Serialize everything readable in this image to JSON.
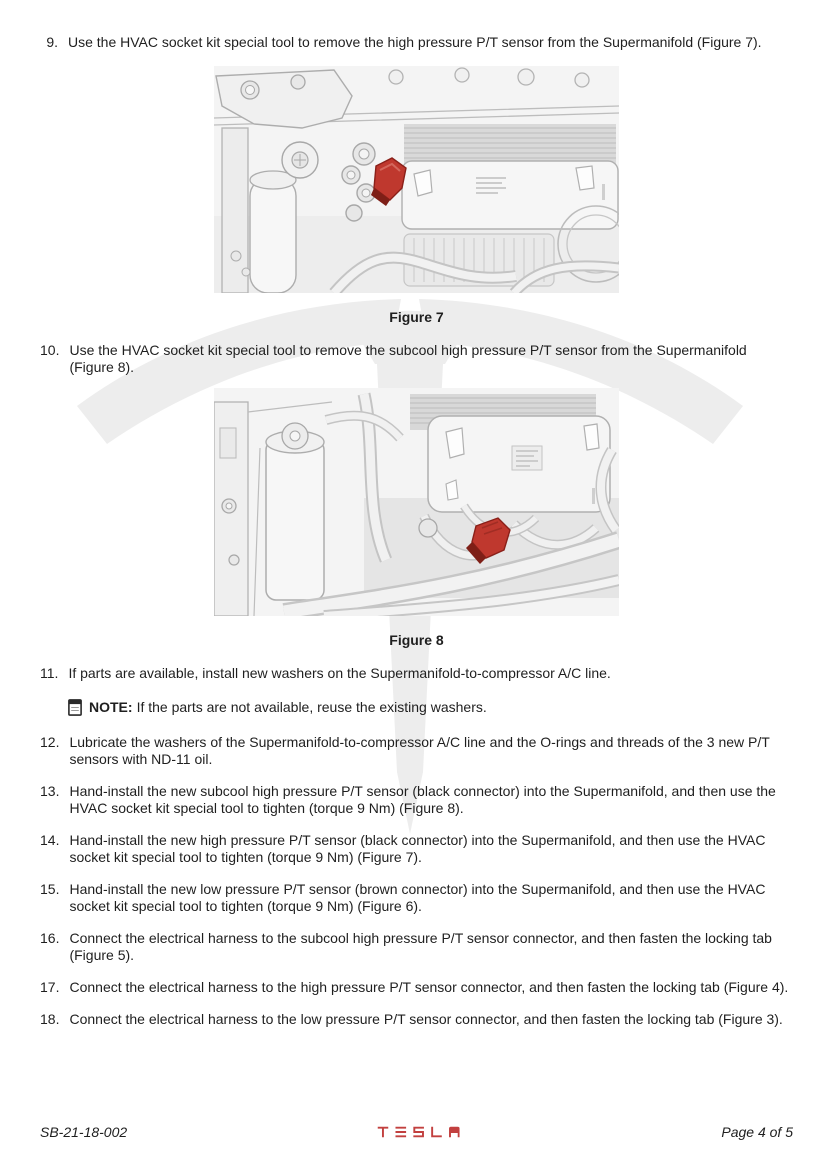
{
  "page": {
    "background": "#ffffff",
    "text_color": "#1f1f1f",
    "watermark_icon": "tesla-t-logo-watermark",
    "watermark_color": "#ededed",
    "highlight_color": "#bf382e"
  },
  "steps": [
    {
      "number": "9.",
      "text": "Use the HVAC socket kit special tool to remove the high pressure P/T sensor from the Supermanifold (Figure 7)."
    },
    {
      "number": "10.",
      "text": "Use the HVAC socket kit special tool to remove the subcool high pressure P/T sensor from the Supermanifold (Figure 8)."
    },
    {
      "number": "11.",
      "text": "If parts are available, install new washers on the Supermanifold-to-compressor A/C line."
    },
    {
      "number": "12.",
      "text": "Lubricate the washers of the Supermanifold-to-compressor A/C line and the O-rings and threads of the 3 new P/T sensors with ND-11 oil."
    },
    {
      "number": "13.",
      "text": "Hand-install the new subcool high pressure P/T sensor (black connector) into the Supermanifold, and then use the HVAC socket kit special tool to tighten (torque 9 Nm) (Figure 8)."
    },
    {
      "number": "14.",
      "text": "Hand-install the new high pressure P/T sensor (black connector) into the Supermanifold, and then use the HVAC socket kit special tool to tighten (torque 9 Nm) (Figure 7)."
    },
    {
      "number": "15.",
      "text": "Hand-install the new low pressure P/T sensor (brown connector) into the Supermanifold, and then use the HVAC socket kit special tool to tighten (torque 9 Nm) (Figure 6)."
    },
    {
      "number": "16.",
      "text": "Connect the electrical harness to the subcool high pressure P/T sensor connector, and then fasten the locking tab (Figure 5)."
    },
    {
      "number": "17.",
      "text": "Connect the electrical harness to the high pressure P/T sensor connector, and then fasten the locking tab (Figure 4)."
    },
    {
      "number": "18.",
      "text": "Connect the electrical harness to the low pressure P/T sensor connector, and then fasten the locking tab (Figure 3)."
    }
  ],
  "figures": [
    {
      "caption": "Figure 7"
    },
    {
      "caption": "Figure 8"
    }
  ],
  "note": {
    "icon": "note-document-icon",
    "label": "NOTE:",
    "text": "If the parts are not available, reuse the existing washers."
  },
  "footer": {
    "doc_number": "SB-21-18-002",
    "logo_text": "TESLA",
    "logo_color": "#c2403f",
    "page_indicator": "Page 4 of 5"
  }
}
